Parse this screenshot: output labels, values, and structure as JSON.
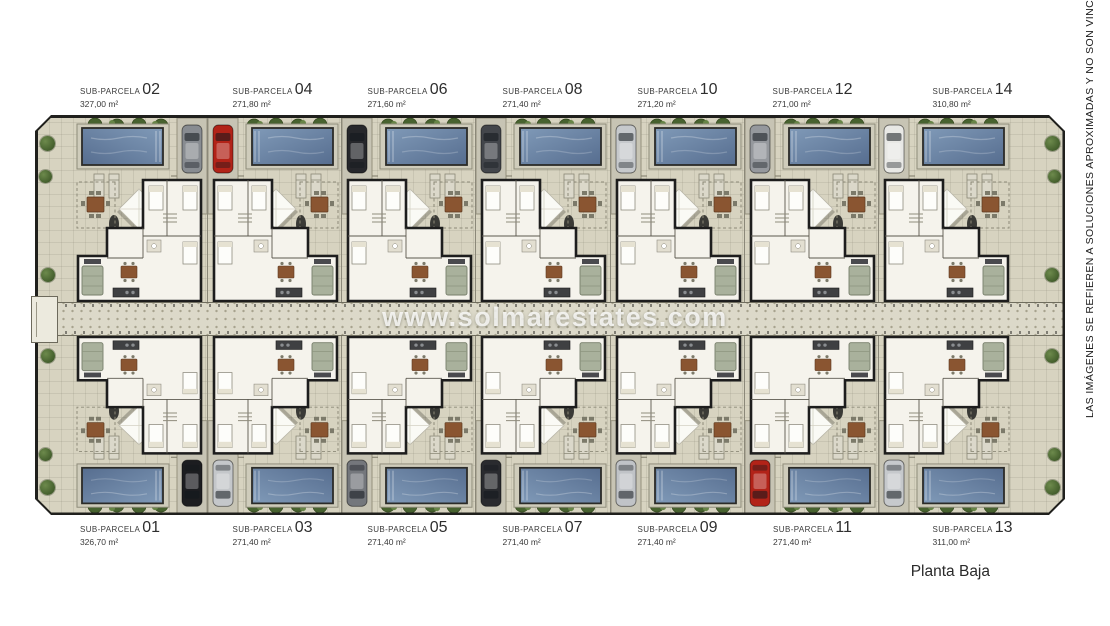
{
  "page": {
    "watermark": "www.solmarestates.com",
    "disclaimer": "LAS IMÁGENES SE REFIEREN A SOLUCIONES APROXIMADAS Y NO SON VINCULANTES A",
    "floor_label": "Planta Baja"
  },
  "parcels": {
    "label_prefix": "SUB-PARCELA",
    "top": [
      {
        "number": "02",
        "area": "327,00 m²",
        "car_color": "#888c91"
      },
      {
        "number": "04",
        "area": "271,80 m²",
        "car_color": "#b22318"
      },
      {
        "number": "06",
        "area": "271,60 m²",
        "car_color": "#26272b"
      },
      {
        "number": "08",
        "area": "271,40 m²",
        "car_color": "#43464b"
      },
      {
        "number": "10",
        "area": "271,20 m²",
        "car_color": "#c6c9cc"
      },
      {
        "number": "12",
        "area": "271,00 m²",
        "car_color": "#95989d"
      },
      {
        "number": "14",
        "area": "310,80 m²",
        "car_color": "#e8e8e5"
      }
    ],
    "bottom": [
      {
        "number": "01",
        "area": "326,70 m²",
        "car_color": "#1c1d20"
      },
      {
        "number": "03",
        "area": "271,40 m²",
        "car_color": "#c4c7ca"
      },
      {
        "number": "05",
        "area": "271,40 m²",
        "car_color": "#74777c"
      },
      {
        "number": "07",
        "area": "271,40 m²",
        "car_color": "#2a2b2f"
      },
      {
        "number": "09",
        "area": "271,40 m²",
        "car_color": "#c0c3c7"
      },
      {
        "number": "11",
        "area": "271,40 m²",
        "car_color": "#b22318"
      },
      {
        "number": "13",
        "area": "311,00 m²",
        "car_color": "#c6c9cc"
      }
    ]
  },
  "colors": {
    "ground": "#d7d3c0",
    "pool_light": "#7e97b5",
    "pool_dark": "#596f91",
    "tree": "#47622f",
    "house_fill": "#f5f3ec",
    "outline": "#1d1d1d"
  }
}
